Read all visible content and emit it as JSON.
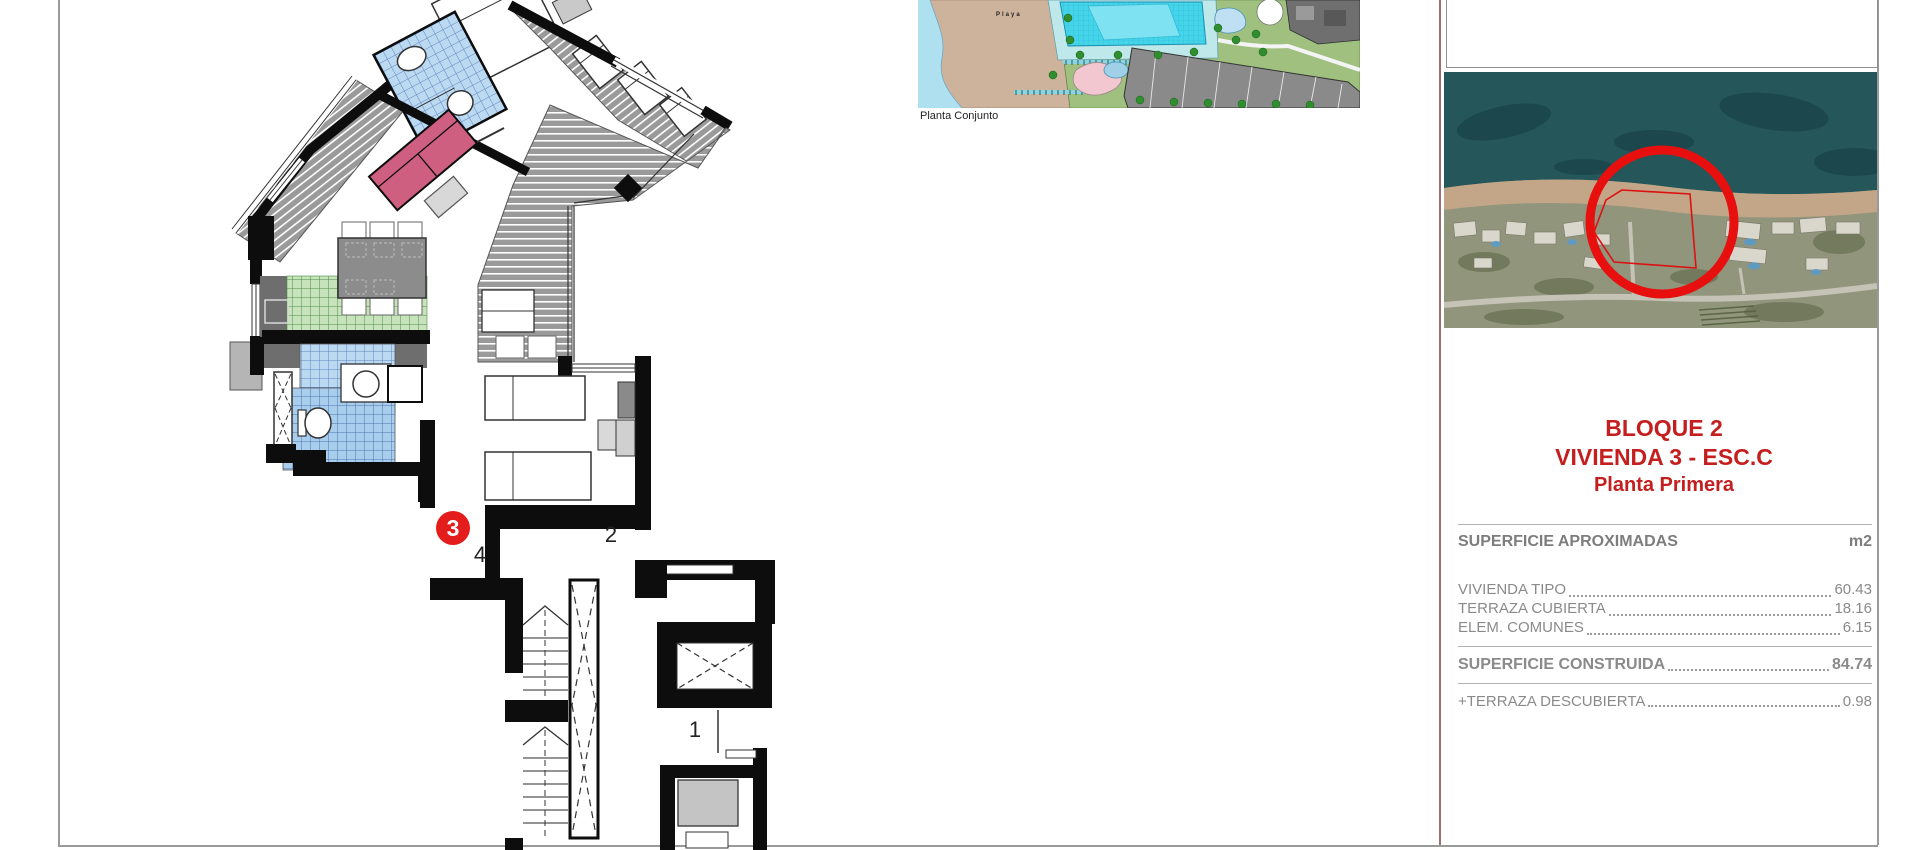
{
  "floorplan": {
    "unit_marker": "3",
    "hall_label": "4",
    "bedroom_label": "2",
    "landing_label": "1"
  },
  "siteplan": {
    "beach_label": "Playa",
    "caption": "Planta Conjunto"
  },
  "panel": {
    "title_line1": "BLOQUE 2",
    "title_line2": "VIVIENDA 3 - ESC.C",
    "title_line3": "Planta Primera",
    "surfaces_header": "SUPERFICIE APROXIMADAS",
    "surfaces_unit": "m2",
    "rows": [
      {
        "label": "VIVIENDA TIPO",
        "value": "60.43"
      },
      {
        "label": "TERRAZA CUBIERTA",
        "value": "18.16"
      },
      {
        "label": "ELEM. COMUNES",
        "value": "6.15"
      }
    ],
    "total": {
      "label": "SUPERFICIE CONSTRUIDA",
      "value": "84.74"
    },
    "extra": {
      "label": "+TERRAZA DESCUBIERTA",
      "value": "0.98"
    }
  },
  "colors": {
    "title_red": "#c41e1e",
    "marker_red": "#e31c1c",
    "separator_maroon": "#9c6f6f",
    "sofa_pink": "#ce5f81",
    "tile_blue": "#bcd9f2",
    "tile_green": "#c7e3bb",
    "floor_gray": "#9a9a9a"
  }
}
